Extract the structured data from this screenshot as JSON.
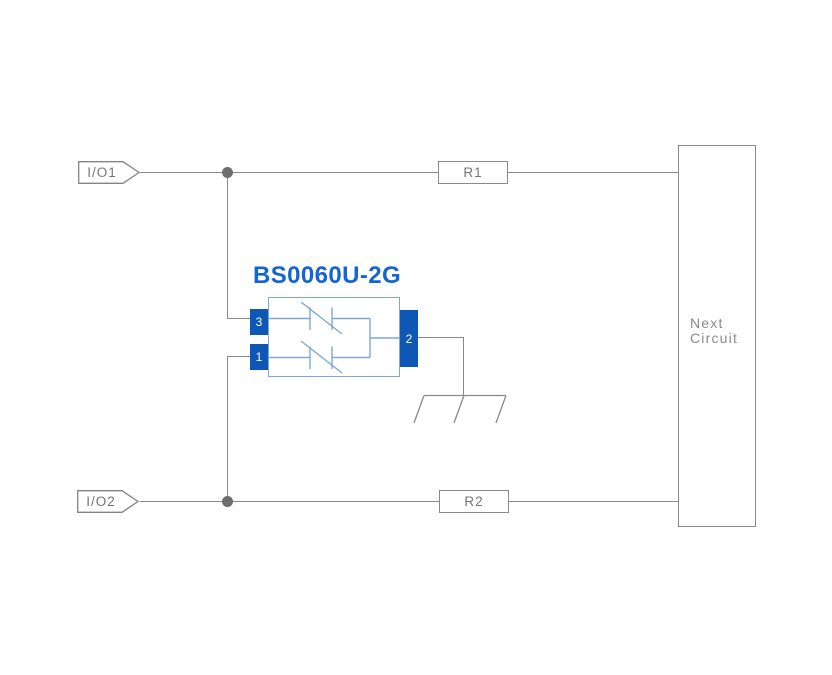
{
  "diagram": {
    "background": "#ffffff",
    "colors": {
      "wire": "#8a8a8a",
      "box_border": "#8a8a8a",
      "label_text": "#757575",
      "junction_dot": "#6e6e6e",
      "pin_fill": "#0e57b4",
      "pin_text": "#ffffff",
      "component_outline": "#7da7db",
      "component_title": "#1465d2"
    },
    "io_flags": [
      {
        "label": "I/O1"
      },
      {
        "label": "I/O2"
      }
    ],
    "resistors": [
      {
        "label": "R1"
      },
      {
        "label": "R2"
      }
    ],
    "component": {
      "title": "BS0060U-2G",
      "pins": [
        {
          "number": "3"
        },
        {
          "number": "1"
        },
        {
          "number": "2"
        }
      ],
      "symbol": "feedthrough-capacitor-pair"
    },
    "next_circuit": {
      "line1": "Next",
      "line2": "Circuit"
    },
    "symbols": [
      "junction-dot",
      "junction-dot",
      "chassis-ground"
    ]
  }
}
